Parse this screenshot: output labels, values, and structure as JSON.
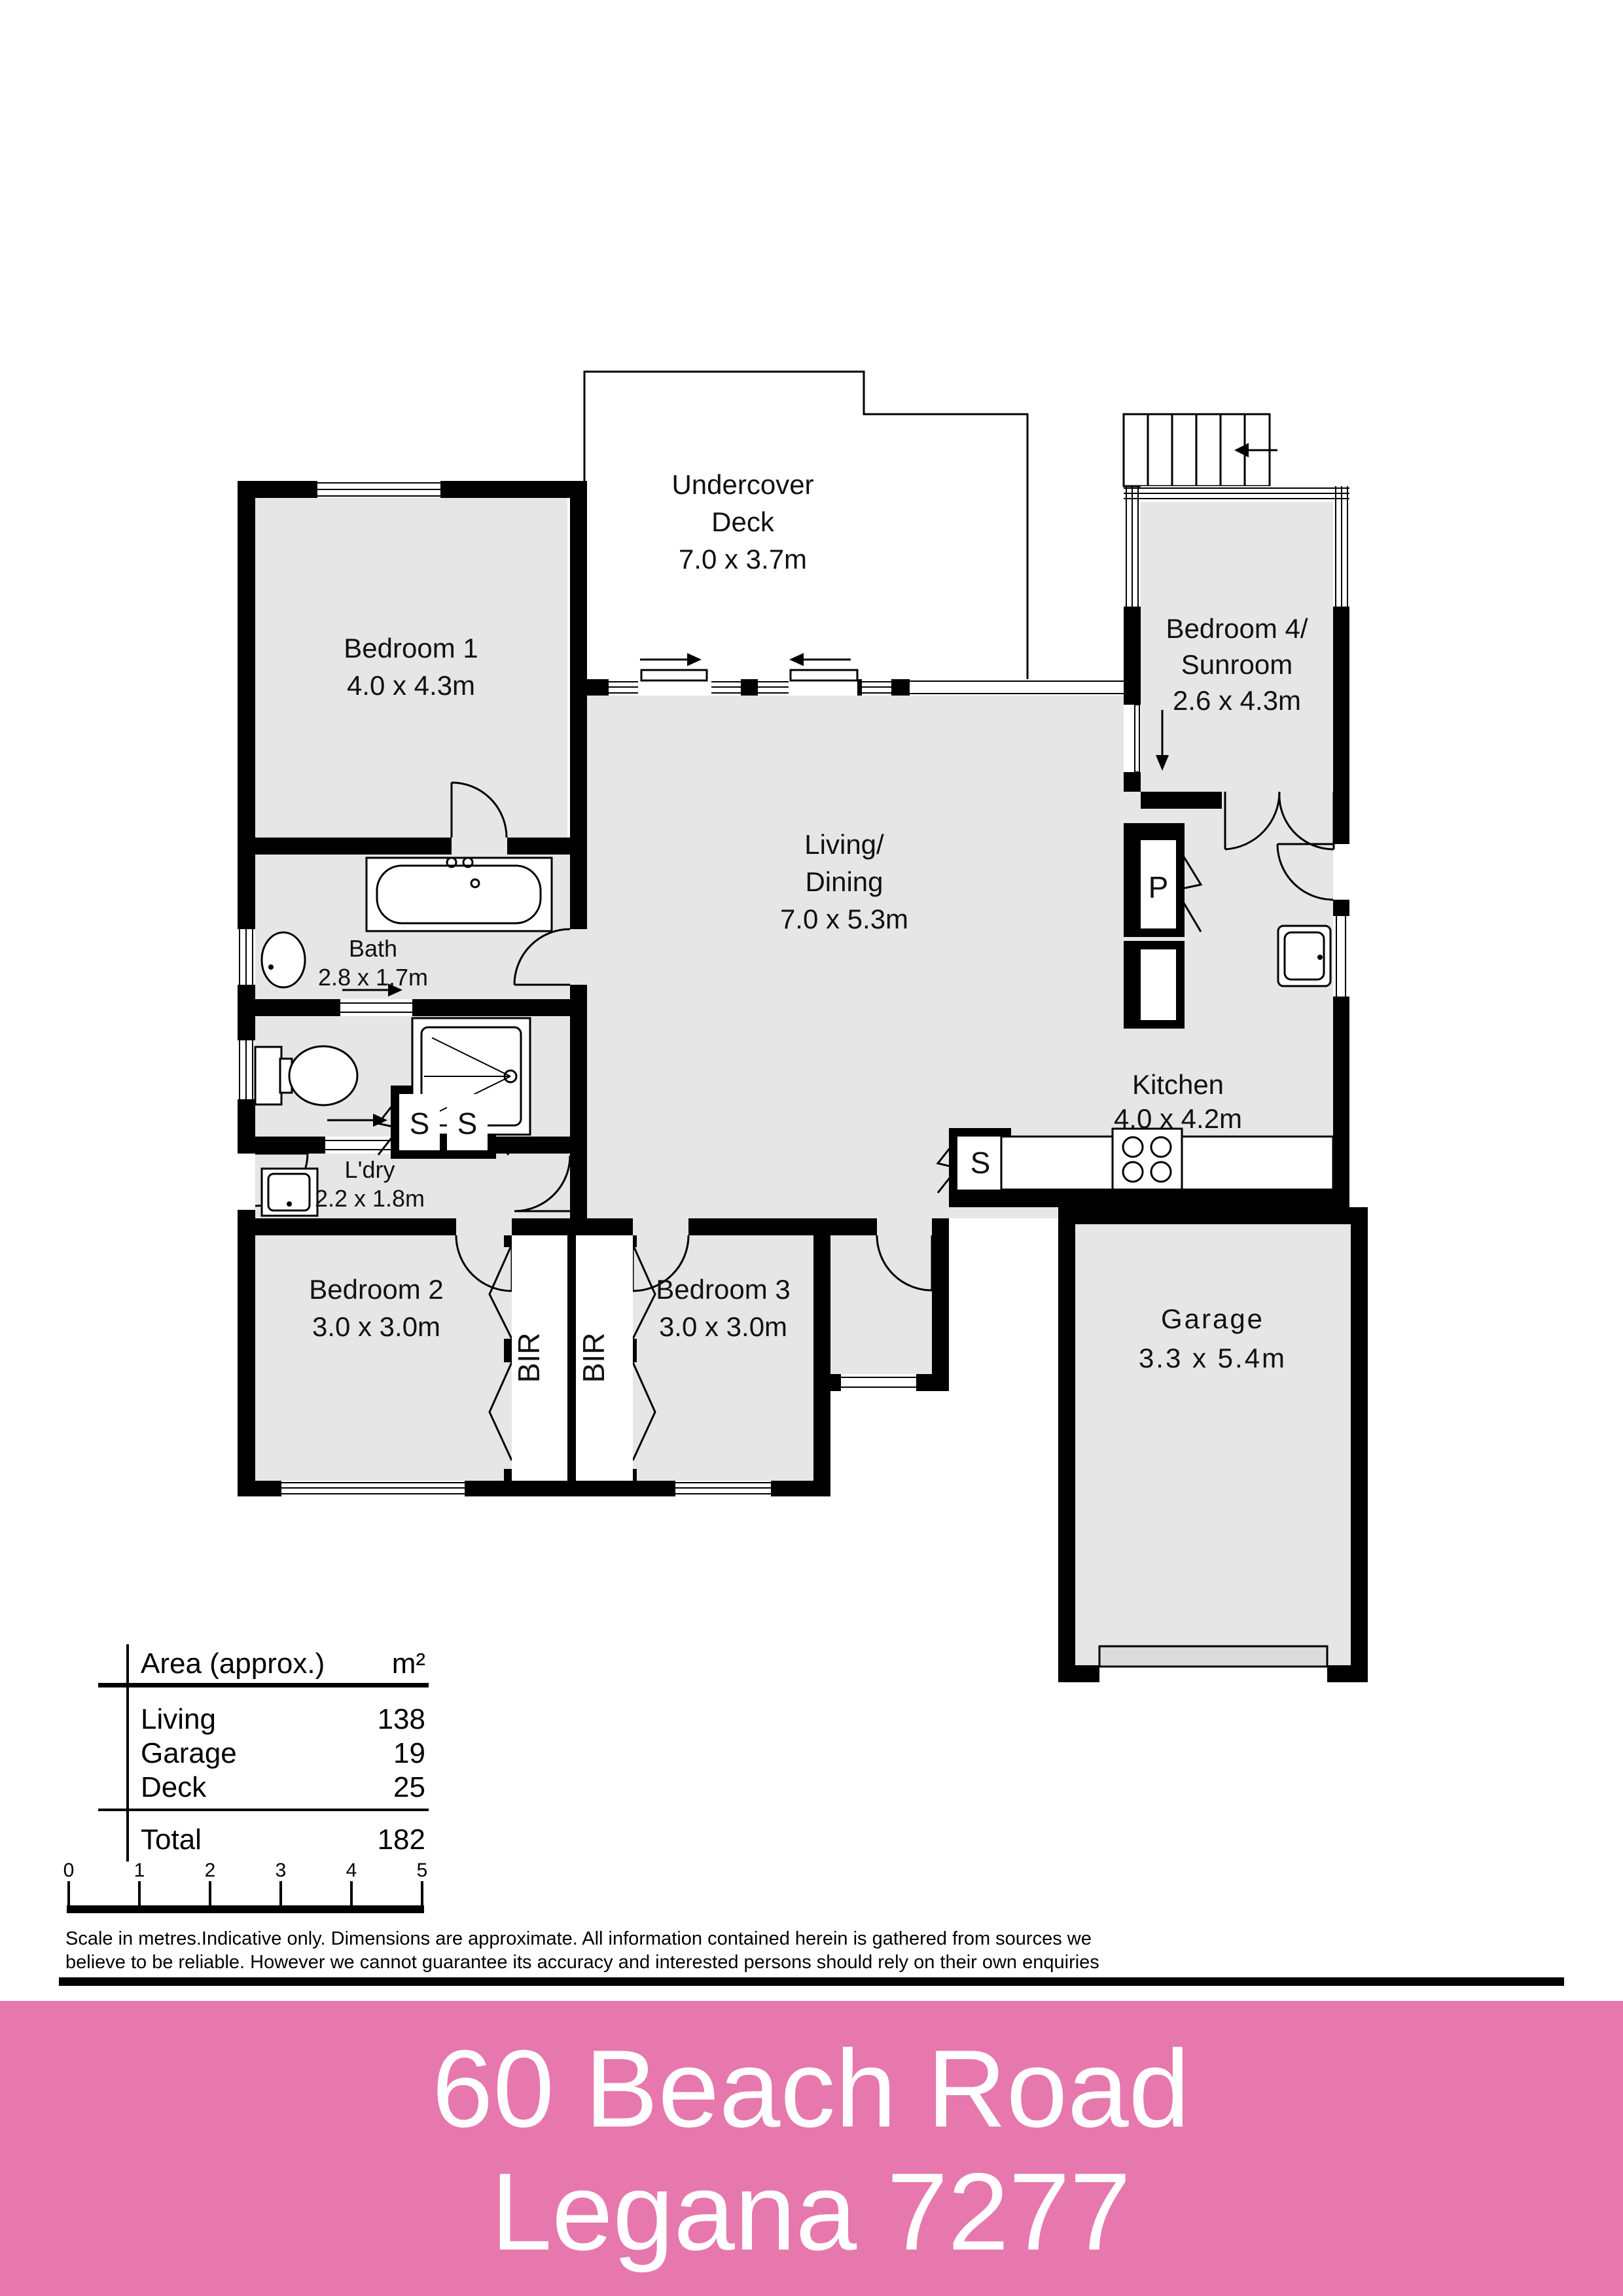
{
  "plan": {
    "deck": {
      "line1": "Undercover",
      "line2": "Deck",
      "dims": "7.0 x 3.7m"
    },
    "bedroom1": {
      "name": "Bedroom 1",
      "dims": "4.0 x 4.3m"
    },
    "bedroom4": {
      "name": "Bedroom 4/",
      "name2": "Sunroom",
      "dims": "2.6 x 4.3m"
    },
    "living": {
      "name": "Living/",
      "name2": "Dining",
      "dims": "7.0 x 5.3m"
    },
    "bath": {
      "name": "Bath",
      "dims": "2.8 x 1.7m"
    },
    "laundry": {
      "name": "L'dry",
      "dims": "2.2 x 1.8m"
    },
    "kitchen": {
      "name": "Kitchen",
      "dims": "4.0 x 4.2m"
    },
    "bedroom2": {
      "name": "Bedroom 2",
      "dims": "3.0 x 3.0m"
    },
    "bedroom3": {
      "name": "Bedroom 3",
      "dims": "3.0 x 3.0m"
    },
    "garage": {
      "name": "Garage",
      "dims": "3.3 x 5.4m"
    },
    "pantry": "P",
    "storage": "S",
    "robe": "BIR"
  },
  "area_table": {
    "header_label": "Area (approx.)",
    "header_unit": "m²",
    "rows": [
      {
        "label": "Living",
        "value": "138"
      },
      {
        "label": "Garage",
        "value": "19"
      },
      {
        "label": "Deck",
        "value": "25"
      }
    ],
    "total_label": "Total",
    "total_value": "182"
  },
  "scale_bar": {
    "ticks": [
      "0",
      "1",
      "2",
      "3",
      "4",
      "5"
    ]
  },
  "disclaimer": {
    "line1": "Scale in metres.Indicative only. Dimensions are approximate. All information contained herein is gathered from sources we",
    "line2": "believe to be reliable. However we cannot guarantee its accuracy and interested persons should rely on their own enquiries"
  },
  "footer": {
    "address": "60 Beach Road",
    "locality": "Legana 7277",
    "background": "#e678ad",
    "text_color": "#ffffff"
  }
}
